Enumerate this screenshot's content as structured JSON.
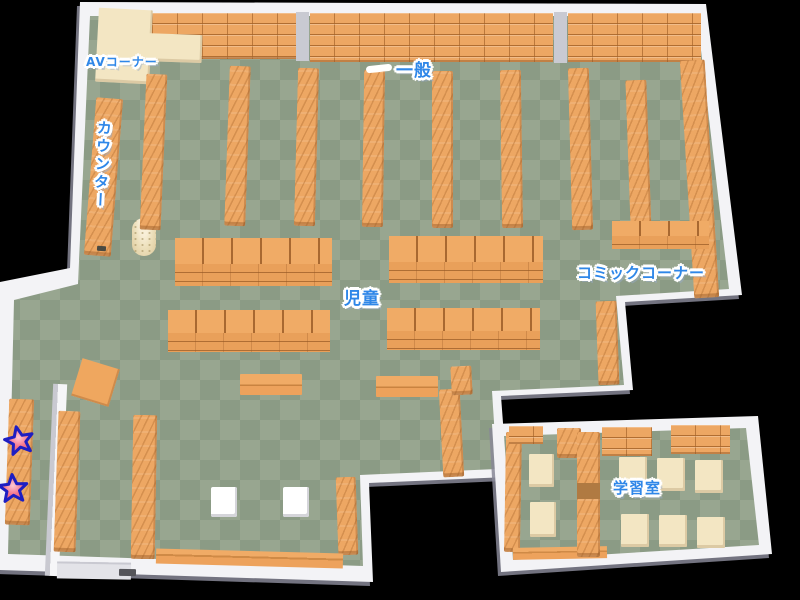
{
  "map": {
    "areas": {
      "av_corner": {
        "label": "AVコーナー"
      },
      "counter": {
        "label": "カウンター"
      },
      "general": {
        "label": "一般"
      },
      "children": {
        "label": "児童"
      },
      "comic_corner": {
        "label": "コミックコーナー"
      },
      "study_room": {
        "label": "学習室"
      }
    },
    "markers": [
      {
        "icon": "star",
        "x": 19,
        "y": 440
      },
      {
        "icon": "star",
        "x": 13,
        "y": 488
      }
    ],
    "colors": {
      "label_blue": "#2f87e8",
      "floor_light": "#98a690",
      "floor_dark": "#8b9b85",
      "shelf_orange": "#eda763",
      "desk_cream": "#f3e6c3",
      "wall_white": "#f3f3f6",
      "star_fill": "#f5768b",
      "star_stroke": "#1e1ec2",
      "background": "#000000"
    }
  }
}
